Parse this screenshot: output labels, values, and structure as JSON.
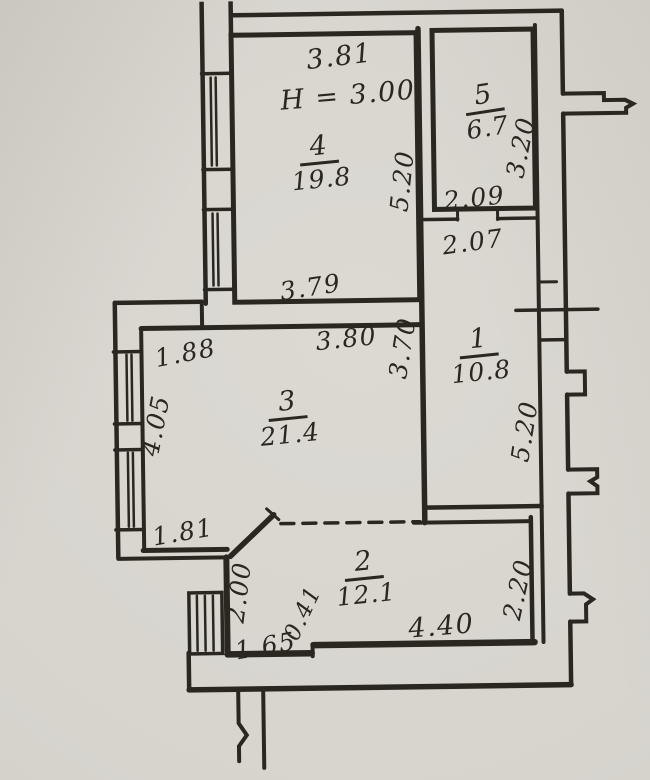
{
  "plan_type": "apartment floor plan (scanned, hand-lettered)",
  "colors": {
    "paper": "#d7d4ce",
    "ink": "#2b2720"
  },
  "ceiling_height": "H = 3.00",
  "rooms": [
    {
      "number": "1",
      "area": "10.8"
    },
    {
      "number": "2",
      "area": "12.1"
    },
    {
      "number": "3",
      "area": "21.4"
    },
    {
      "number": "4",
      "area": "19.8"
    },
    {
      "number": "5",
      "area": "6.7"
    }
  ],
  "dimensions": {
    "room4_width_top": "3.81",
    "room4_depth": "5.20",
    "room5_depth": "3.20",
    "hall_width_top": "2.09",
    "hall_width": "2.07",
    "room4_width_bottom": "3.79",
    "room3_width_top": "3.80",
    "room3_right_depth": "3.70",
    "room3_step_width": "1.88",
    "room3_left_depth": "4.05",
    "hall_depth": "5.20",
    "entry_width": "1.81",
    "entry_depth": "2.00",
    "door_width": "0.41",
    "entry_bottom_width": "1.65",
    "room2_width": "4.40",
    "room2_depth": "2.20"
  }
}
